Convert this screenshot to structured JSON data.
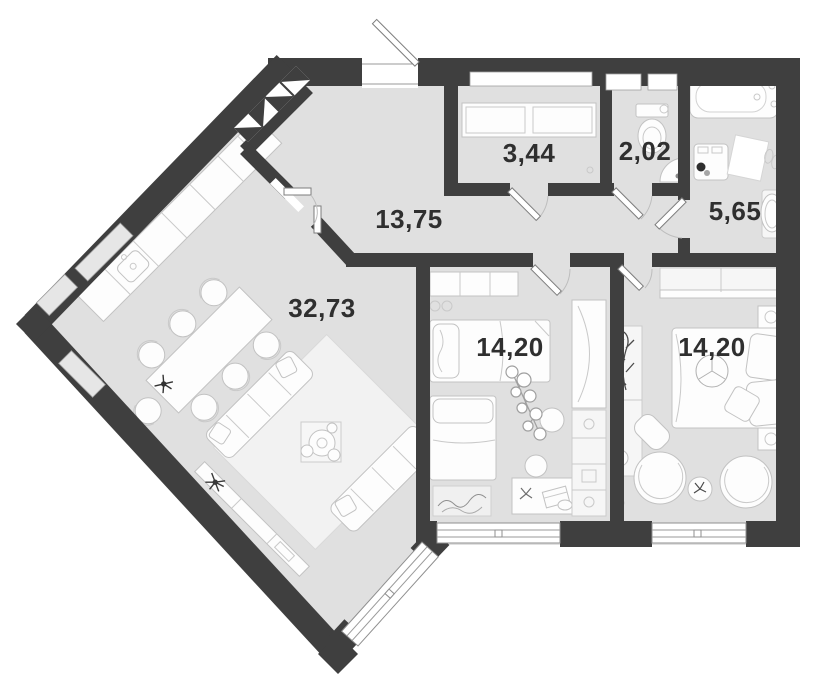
{
  "floor_plan": {
    "rooms": [
      {
        "name": "living-kitchen",
        "area_label": "32,73"
      },
      {
        "name": "hallway",
        "area_label": "13,75"
      },
      {
        "name": "wardrobe",
        "area_label": "3,44"
      },
      {
        "name": "wc",
        "area_label": "2,02"
      },
      {
        "name": "bathroom",
        "area_label": "5,65"
      },
      {
        "name": "bedroom-1",
        "area_label": "14,20"
      },
      {
        "name": "bedroom-2",
        "area_label": "14,20"
      }
    ],
    "colors": {
      "wall": "#3f3f3f",
      "floor": "#e0e0e0",
      "background": "#ffffff",
      "furniture": "#fdfdfd",
      "furniture_outline": "#c2c2c2",
      "window_frame": "#8f8f8f",
      "label_text": "#2f2f2f"
    }
  }
}
